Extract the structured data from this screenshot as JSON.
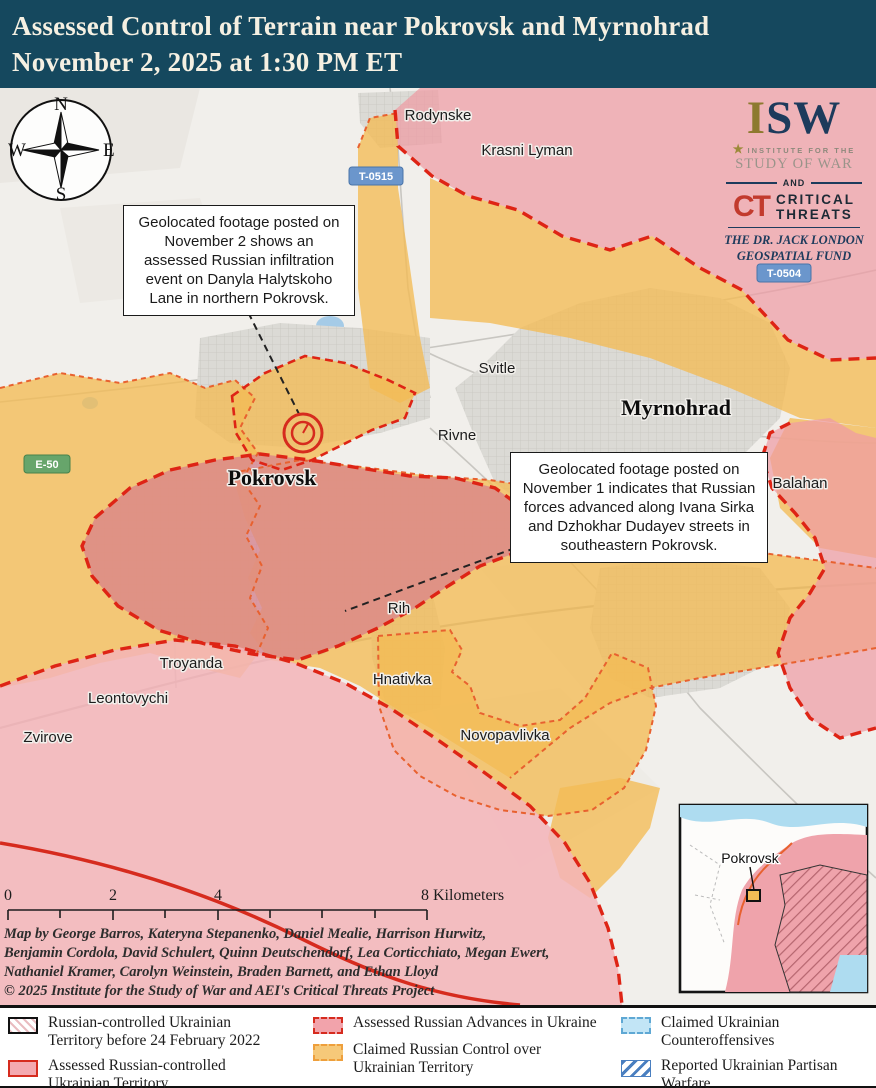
{
  "header": {
    "title_line1": "Assessed Control of Terrain near Pokrovsk and Myrnohrad",
    "title_line2": "November 2, 2025 at 1:30 PM ET"
  },
  "map": {
    "compass": {
      "n": "N",
      "e": "E",
      "s": "S",
      "w": "W"
    },
    "callouts": [
      {
        "text": "Geolocated footage posted on November 2 shows an assessed Russian infiltration event on Danyla Halytskoho Lane in northern Pokrovsk."
      },
      {
        "text": "Geolocated footage posted on November 1 indicates that Russian forces advanced along Ivana Sirka and Dzhokhar Dudayev streets in southeastern Pokrovsk."
      }
    ],
    "cities": [
      {
        "name": "Pokrovsk"
      },
      {
        "name": "Myrnohrad"
      }
    ],
    "towns": [
      {
        "name": "Rodynske"
      },
      {
        "name": "Krasni Lyman"
      },
      {
        "name": "Svitle"
      },
      {
        "name": "Rivne"
      },
      {
        "name": "Balahan"
      },
      {
        "name": "Rih"
      },
      {
        "name": "Hnativka"
      },
      {
        "name": "Troyanda"
      },
      {
        "name": "Leontovychi"
      },
      {
        "name": "Zvirove"
      },
      {
        "name": "Novopavlivka"
      }
    ],
    "road_badges": [
      {
        "label": "T-0515"
      },
      {
        "label": "T-0504"
      },
      {
        "label": "E-50"
      }
    ],
    "inset": {
      "label": "Pokrovsk"
    }
  },
  "logos": {
    "isw": "ISW",
    "institute_line1": "INSTITUTE FOR THE",
    "institute_line2": "STUDY OF WAR",
    "and": "AND",
    "ct": "CT",
    "critical": "CRITICAL",
    "threats": "THREATS",
    "fund_line1": "THE DR. JACK LONDON",
    "fund_line2": "GEOSPATIAL FUND"
  },
  "scalebar": {
    "t0": "0",
    "t2": "2",
    "t4": "4",
    "t8": "8 Kilometers"
  },
  "credits": {
    "line1": "Map by George Barros, Kateryna Stepanenko, Daniel Mealie, Harrison Hurwitz,",
    "line2": "Benjamin Cordola, David Schulert, Quinn Deutschendorf, Lea Corticchiato, Megan Ewert,",
    "line3": "Nathaniel Kramer, Carolyn Weinstein, Braden Barnett, and Ethan Lloyd",
    "line4": "© 2025 Institute for the Study of War and AEI's Critical Threats Project"
  },
  "legend": {
    "items": [
      {
        "label": "Russian-controlled Ukrainian Territory before 24 February 2022"
      },
      {
        "label": "Assessed Russian-controlled Ukrainian Territory"
      },
      {
        "label": "Assessed Russian Advances in Ukraine"
      },
      {
        "label": "Claimed Russian Control over Ukrainian Territory"
      },
      {
        "label": "Claimed Ukrainian Counteroffensives"
      },
      {
        "label": "Reported Ukrainian Partisan Warfare"
      }
    ]
  },
  "colors": {
    "header_bg": "#15485e",
    "claimed_russian_orange": "#f3bb55",
    "assessed_advance_pink": "#ef9ba4",
    "assessed_control_pink": "#f3b4b9",
    "advance_border_red": "#de2415",
    "claimed_border_orange": "#e8612f",
    "counteroffensive_blue": "#c2e5f6",
    "partisan_blue": "#4a7fc0"
  }
}
